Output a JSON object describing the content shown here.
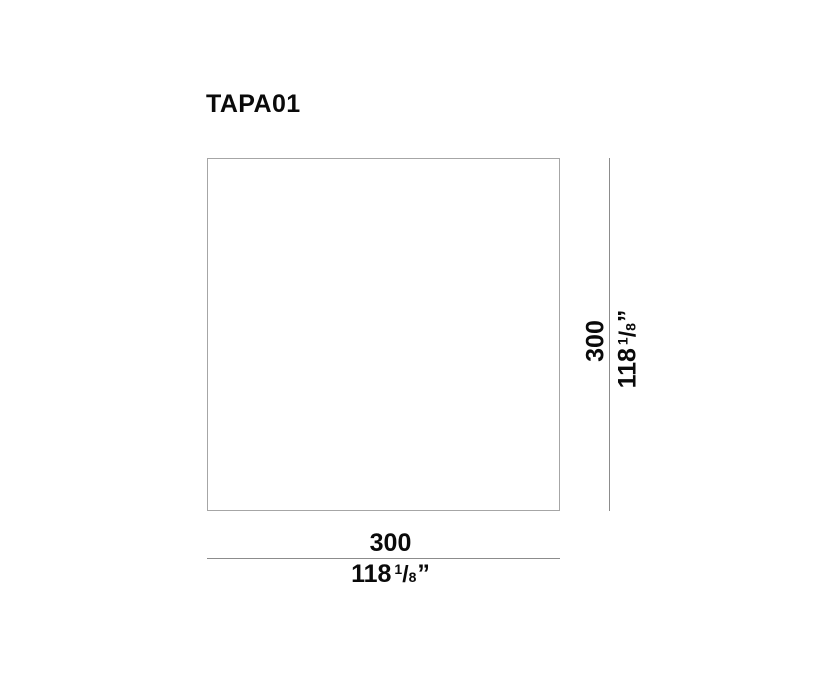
{
  "title": "TAPA01",
  "drawing": {
    "shape": "square",
    "colors": {
      "background": "#ffffff",
      "outline": "#a6a6a6",
      "dimension_line": "#8c8c8c",
      "text": "#0a0a0a"
    }
  },
  "dimensions": {
    "height": {
      "metric_value": "300",
      "imperial_whole": "118",
      "imperial_fraction_numerator": "1",
      "imperial_fraction_slash": "/",
      "imperial_fraction_denominator": "8",
      "imperial_unit_mark": "”"
    },
    "width": {
      "metric_value": "300",
      "imperial_whole": "118",
      "imperial_fraction_numerator": "1",
      "imperial_fraction_slash": "/",
      "imperial_fraction_denominator": "8",
      "imperial_unit_mark": "”"
    }
  }
}
